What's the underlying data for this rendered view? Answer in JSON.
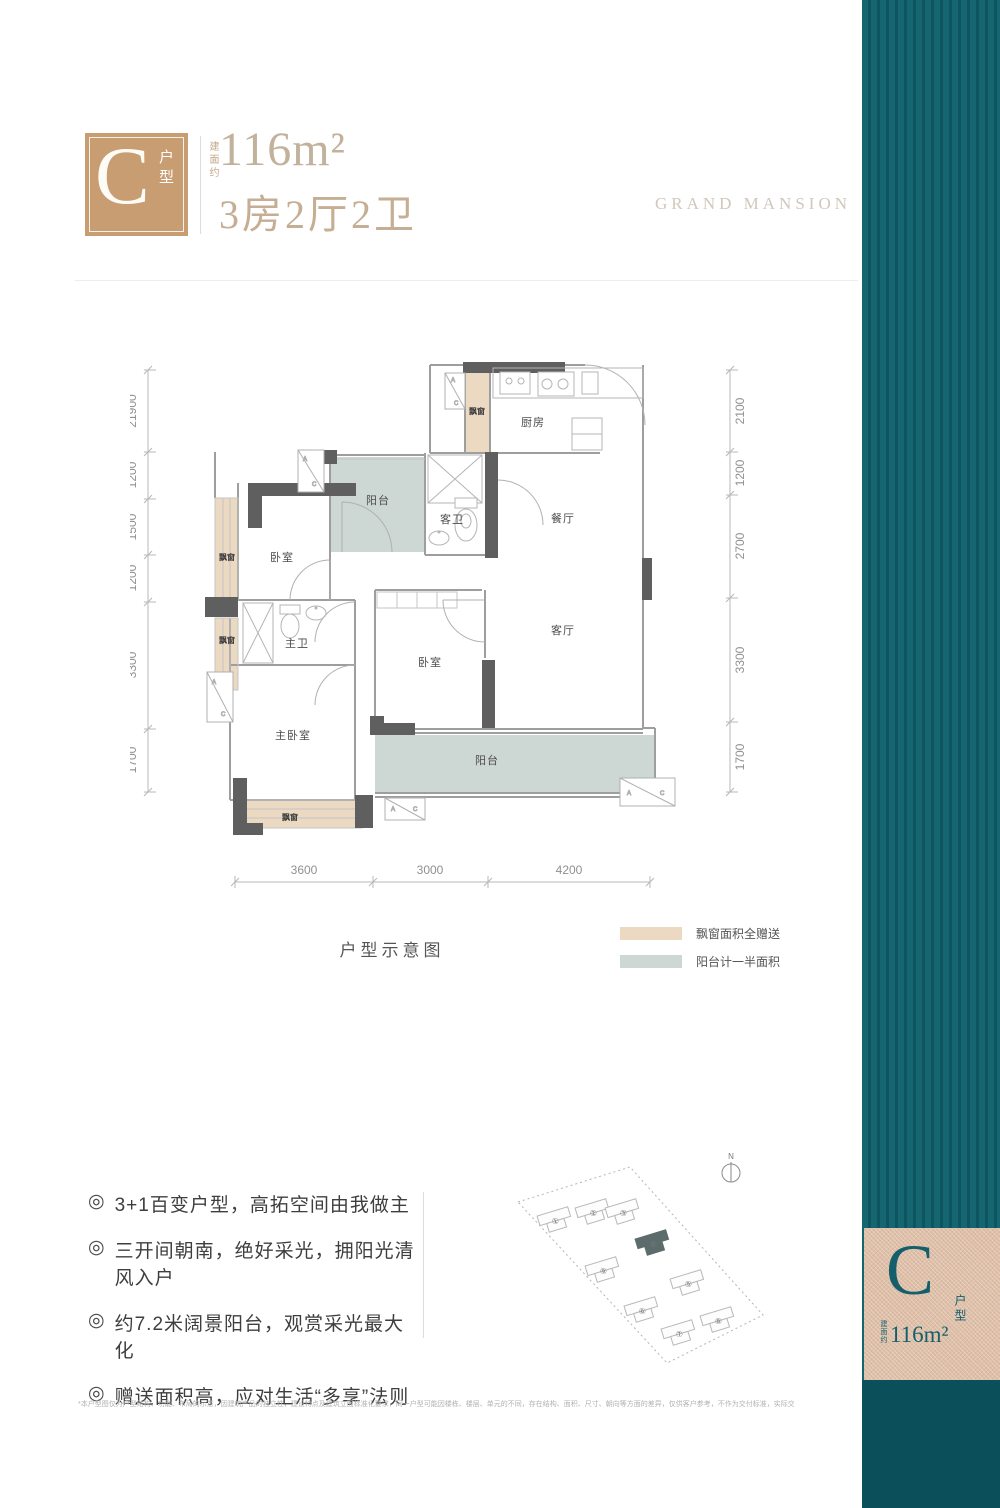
{
  "header": {
    "badge_letter": "C",
    "badge_suffix": "户型",
    "area_prefix": "建面约",
    "area_value": "116m²",
    "layout_text": "3房2厅2卫",
    "brand": "GRAND MANSION"
  },
  "floorplan": {
    "caption": "户型示意图",
    "labels": {
      "kitchen": "厨房",
      "dining": "餐厅",
      "living": "客厅",
      "bedroom": "卧室",
      "master_bedroom": "主卧室",
      "guest_bath": "客卫",
      "master_bath": "主卫",
      "balcony": "阳台",
      "bay": "飘窗",
      "ac_a": "A",
      "ac_c": "C"
    },
    "dims_left": [
      "21900",
      "1200",
      "1500",
      "1200",
      "3300",
      "1700"
    ],
    "dims_right": [
      "2100",
      "1200",
      "2700",
      "3300",
      "1700"
    ],
    "dims_bottom": [
      "3600",
      "3000",
      "4200"
    ],
    "legend_bay": "飘窗面积全赠送",
    "legend_balcony": "阳台计一半面积"
  },
  "features": {
    "bullet": "◎",
    "items": [
      "3+1百变户型，高拓空间由我做主",
      "三开间朝南，绝好采光，拥阳光清风入户",
      "约7.2米阔景阳台，观赏采光最大化",
      "赠送面积高，应对生活“多享”法则"
    ]
  },
  "siteplan": {
    "north": "N",
    "buildings": [
      "①",
      "②",
      "③",
      "④",
      "⑤",
      "⑥",
      "⑦",
      "⑧",
      "⑨"
    ]
  },
  "banner": {
    "badge_letter": "C",
    "badge_suffix": "户型",
    "area_prefix": "建面约",
    "area_value": "116m²"
  },
  "colors": {
    "banner_teal": "#166671",
    "banner_teal_dark": "#0f5560",
    "banner_bottom": "#0b4f5b",
    "badge_copper": "#debfa8",
    "logo_copper": "#c89d72",
    "bay_fill": "#ecd9c2",
    "balcony_fill": "#cdd7d3",
    "wall_dark": "#5f5f5f"
  },
  "disclaimer": "*本户型图仅为户型结构、功能、布局的示意，因建筑产品的独立性，建设特点及建筑立面标准化要求，同一户型可能因楼栋、楼层、单元的不同，存在结构、面积、尺寸、朝向等方面的差异，仅供客户参考，不作为交付标准，实际交付以买卖双方签订的商品房买卖合同及其附图的约定为准。"
}
